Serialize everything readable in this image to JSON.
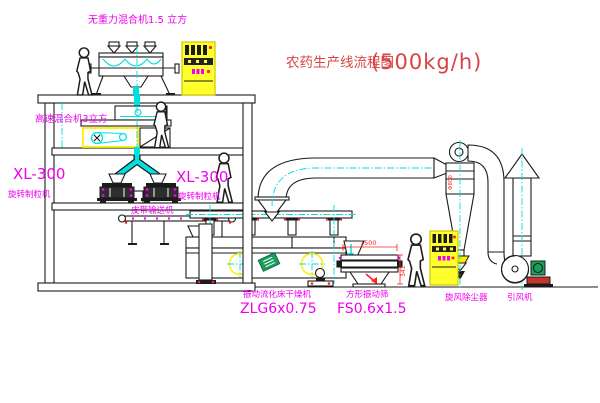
{
  "title": {
    "name": "农药生产线流程图",
    "capacity": "(500kg/h)"
  },
  "equipment": {
    "gravity_mixer": {
      "label": "无重力混合机1.5 立方"
    },
    "highspeed_mixer": {
      "label": "高速混合机3立方"
    },
    "granulator_left": {
      "model": "XL-300",
      "name": "旋转制粒机"
    },
    "granulator_right": {
      "model": "XL-300",
      "name": "旋转制粒机"
    },
    "belt_conveyor": {
      "name": "皮带输送机"
    },
    "fluid_bed_dryer": {
      "name": "振动流化床干燥机",
      "model": "ZLG6x0.75"
    },
    "square_sieve": {
      "name": "方形振动筛",
      "model": "FS0.6x1.5"
    },
    "cyclone": {
      "name": "旋风除尘器"
    },
    "induced_draft_fan": {
      "name": "引风机"
    }
  },
  "dimensions": {
    "sieve_width": "1500",
    "sieve_height": "341",
    "cyclone_note": "Φ800"
  },
  "colors": {
    "line": "#1b1b1b",
    "label": "#f000f0",
    "title": "#d84444",
    "dimension": "#ff2222",
    "centerline": "#00dcdc",
    "pipe": "#00e0e0",
    "cabinet": "#ffff2d",
    "cabinet_border": "#cfc400",
    "highlight": "#ffee00",
    "motor": "#18a05c",
    "base_red": "#c23527"
  }
}
